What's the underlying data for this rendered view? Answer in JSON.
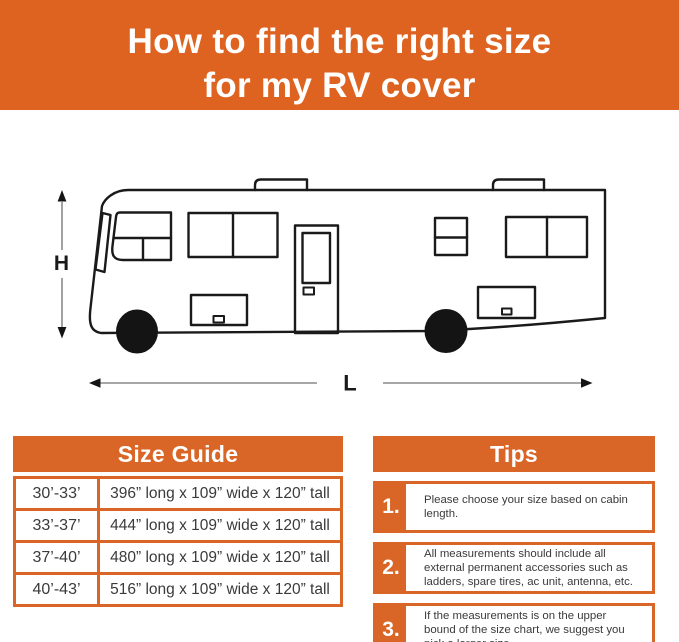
{
  "colors": {
    "banner_orange": "#DE6320",
    "panel_orange": "#D96526",
    "line_art": "#1a1a1a",
    "body_text": "#3a3a3a",
    "arrow_gray": "#8a8a8a"
  },
  "banner": {
    "title_line1": "How to find the right size",
    "title_line2": "for my RV cover"
  },
  "diagram": {
    "h_label": "H",
    "l_label": "L"
  },
  "size_guide": {
    "title": "Size Guide",
    "rows": [
      {
        "range": "30’-33’",
        "dimensions": "396” long x 109” wide x 120” tall"
      },
      {
        "range": "33’-37’",
        "dimensions": "444” long x 109” wide x 120” tall"
      },
      {
        "range": "37’-40’",
        "dimensions": "480” long x 109” wide x 120” tall"
      },
      {
        "range": "40’-43’",
        "dimensions": "516”  long x 109” wide x 120” tall"
      }
    ]
  },
  "tips": {
    "title": "Tips",
    "items": [
      {
        "number": "1.",
        "text": "Please choose your size based on cabin length."
      },
      {
        "number": "2.",
        "text": "All measurements should include all external permanent accessories such as ladders, spare tires, ac unit, antenna, etc."
      },
      {
        "number": "3.",
        "text": "If the measurements is on the upper bound of the size chart, we suggest you pick a larger size."
      }
    ]
  }
}
